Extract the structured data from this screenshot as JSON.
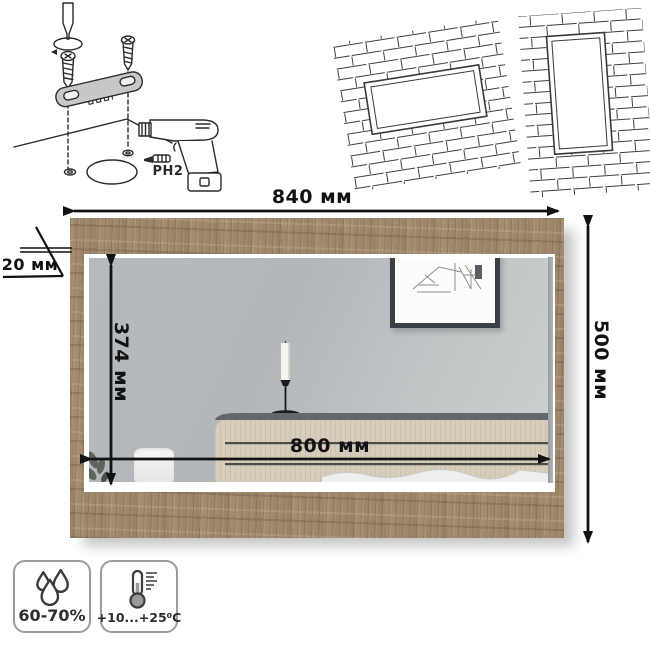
{
  "diagram": {
    "title": "wall mirror assembly and dimensions diagram",
    "dimensions": {
      "overall_width": "840 мм",
      "overall_height": "500 мм",
      "glass_height": "374 мм",
      "glass_width": "800 мм",
      "frame_depth": "20 мм"
    },
    "assembly": {
      "bit_label": "PH2",
      "parts": [
        "screwdriver",
        "screws",
        "mounting-bracket",
        "drill",
        "ph2-bit"
      ]
    },
    "mounting_options": [
      "horizontal-on-brick-wall",
      "vertical-on-brick-wall"
    ],
    "operating_conditions": {
      "humidity": "60-70%",
      "temperature": "+10...+25⁰C"
    },
    "icons": {
      "humidity": "water-drops-icon",
      "temperature": "thermometer-icon"
    },
    "colors": {
      "wood_frame": "#a38c6d",
      "mirror_glass": "#b9bec1",
      "dimension_lines": "#121212",
      "bracket_fill": "#c7c7c7"
    }
  }
}
